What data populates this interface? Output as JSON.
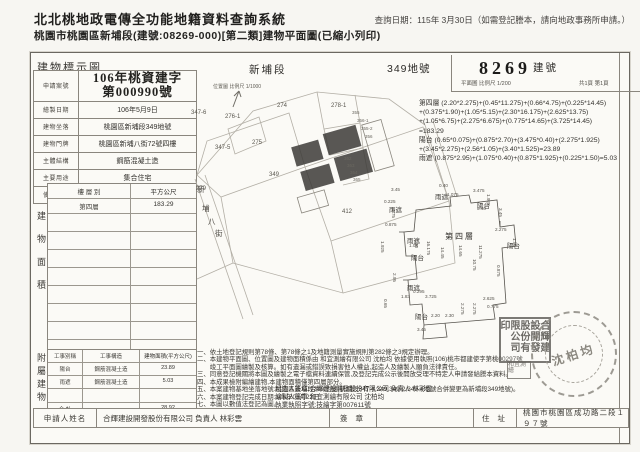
{
  "header": {
    "system_title": "北北桃地政電傳全功能地籍資料查詢系統",
    "query_date": "查詢日期：115年 3月30日（如需登記謄本，請向地政事務所申請。）",
    "doc_title": "桃園市桃園區新埔段(建號:08269-000)[第二類]建物平面圖(已縮小列印)"
  },
  "doc": {
    "diagram_label": "建物標示圖",
    "section_name": "新埔段",
    "lot_label": "349地號",
    "building_no": "8269",
    "building_label": "建號",
    "scale_plan": "平面圖 比例尺 1/200",
    "page_info": "共1頁 第1頁",
    "info_rows": [
      {
        "label": "申請案號",
        "value1": "106年桃資建字",
        "value2": "第000990號"
      },
      {
        "label": "繪製日期",
        "value": "106年5月9日"
      },
      {
        "label": "建物坐落",
        "value": "桃園區新埔段349地號"
      },
      {
        "label": "建物門牌",
        "value": "桃園區新埔八街72號四樓"
      },
      {
        "label": "主體結構",
        "value": "鋼筋混凝土造"
      },
      {
        "label": "主要用途",
        "value": "集合住宅"
      },
      {
        "label": "使用執照",
        "value": "(106)桃市都建使字第00297號"
      }
    ],
    "floor_section_label": "建物面積",
    "floor_table": {
      "col1": "樓 層 別",
      "col2": "平方公尺",
      "row_floor": "第四層",
      "row_area": "183.29",
      "total_label": "合  計",
      "total": "183.29"
    },
    "attached_section_label": "附屬建物",
    "attached_table": {
      "col1": "工事別稱",
      "col2": "工事構造",
      "col3": "建物面積(平方公尺)",
      "rows": [
        {
          "kind": "陽台",
          "structure": "鋼筋混凝土造",
          "area": "23.89"
        },
        {
          "kind": "雨遮",
          "structure": "鋼筋混凝土造",
          "area": "5.03"
        }
      ],
      "total_label": "合  計",
      "total": "28.92"
    },
    "calc_lines": [
      "第四層 (2.20*2.275)+(0.45*11.275)+(0.66*4.75)+(0.225*14.45)",
      "          +(0.375*1.90)+(1.05*5.15)+(2.30*16.175)+(2.625*13.75)",
      "          +(1.05*6.75)+(2.275*6.675)+(0.775*14.65)+(3.725*14.45)",
      "          =183.29",
      "陽台 (0.65*0.075)+(0.875*2.70)+(3.475*0.40)+(2.275*1.925)",
      "          +(3.45*2.275)+(2.56*1.05)+(3.40*1.525)=23.89",
      "雨遮 (0.875*2.95)+(1.075*0.40)+(0.875*1.925)+(0.225*1.50)=5.03"
    ],
    "notes_lines": [
      "一、依土地登記規則第78條、第78條之1及地籍測量實施規則第282條之3規定辦理。",
      "二、本建物平面圖、位置圖及建物面積係由 和宜測繪有限公司 沈柏均 依據使用執照(106)桃市都建使字第桃00297號",
      "　　竣工平面圖繪製及核算。如有遺漏或錯誤致損害他人權益,起造人及繪製人願負法律責任。",
      "三、同意登記機關將本圖及繪製之電子檔資料連續保管,及登記完成公示後開放受理不特定人申請發給謄本資料。",
      "四、本成果檢附編繪建物,本建物面積僅第四層部分。",
      "五、本案建物基地坐落地號:桃園區新埔段349地號(新埔段347-4,349,349-2,349-4地號合併變更為新埔段349地號)。",
      "六、本案建物登記完成日期:106年03月22日",
      "七、本圖以數值法登記為圖。"
    ],
    "sign_lines": [
      "起造人簽章:合輝建設開發股份有限公司 負責人 林彩雲",
      "繪製人簽章:和宜測繪有限公司 沈柏均",
      "執業執照字號:技繪字第007611號"
    ],
    "applicant": {
      "label": "申請人姓名",
      "name": "合輝建設開發股份有限公司 負責人 林彩雲",
      "sign_label": "簽 章",
      "addr_label": "住 址",
      "address": "桃園市桃園區成功路二段１９７號"
    },
    "location_map": {
      "caption": "位置圖 比例尺 1/1000",
      "labels": [
        {
          "t": "347-6",
          "x": 0,
          "y": 27
        },
        {
          "t": "276-1",
          "x": 34,
          "y": 31
        },
        {
          "t": "274",
          "x": 86,
          "y": 20
        },
        {
          "t": "278-1",
          "x": 140,
          "y": 20
        },
        {
          "t": "355",
          "x": 161,
          "y": 27,
          "c": "tiny"
        },
        {
          "t": "356-1",
          "x": 166,
          "y": 35,
          "c": "tiny"
        },
        {
          "t": "355-2",
          "x": 170,
          "y": 43,
          "c": "tiny"
        },
        {
          "t": "356",
          "x": 174,
          "y": 51,
          "c": "tiny"
        },
        {
          "t": "347-5",
          "x": 24,
          "y": 62
        },
        {
          "t": "275",
          "x": 61,
          "y": 57
        },
        {
          "t": "279",
          "x": 5,
          "y": 103
        },
        {
          "t": "349",
          "x": 78,
          "y": 89
        },
        {
          "t": "362",
          "x": 153,
          "y": 73,
          "c": "tiny"
        },
        {
          "t": "363",
          "x": 156,
          "y": 80,
          "c": "tiny"
        },
        {
          "t": "364",
          "x": 159,
          "y": 87,
          "c": "tiny"
        },
        {
          "t": "365",
          "x": 162,
          "y": 94,
          "c": "tiny"
        },
        {
          "t": "412",
          "x": 151,
          "y": 126
        },
        {
          "t": "新",
          "x": 6,
          "y": 101,
          "c": "street"
        },
        {
          "t": "埔",
          "x": 11,
          "y": 120,
          "c": "street"
        },
        {
          "t": "八",
          "x": 17,
          "y": 133,
          "c": "street"
        },
        {
          "t": "街",
          "x": 24,
          "y": 145,
          "c": "street"
        }
      ]
    },
    "floor_plan": {
      "labels": [
        {
          "t": "雨遮",
          "x": 52,
          "y": 8
        },
        {
          "t": "陽台",
          "x": 94,
          "y": 17
        },
        {
          "t": "雨遮",
          "x": 6,
          "y": 21
        },
        {
          "t": "雨遮",
          "x": 24,
          "y": 52
        },
        {
          "t": "陽台",
          "x": 28,
          "y": 69
        },
        {
          "t": "第四層",
          "x": 62,
          "y": 48,
          "c": "big"
        },
        {
          "t": "陽台",
          "x": 124,
          "y": 57
        },
        {
          "t": "雨遮",
          "x": 24,
          "y": 99
        },
        {
          "t": "陽台",
          "x": 32,
          "y": 128
        }
      ],
      "dims": [
        {
          "t": "3.45",
          "x": 8,
          "y": 4
        },
        {
          "t": "0.40",
          "x": 56,
          "y": 0
        },
        {
          "t": "1.075",
          "x": 64,
          "y": 9
        },
        {
          "t": "3.475",
          "x": 90,
          "y": 5
        },
        {
          "t": "1.925",
          "x": 108,
          "y": 11,
          "v": 1
        },
        {
          "t": "3.40",
          "x": 94,
          "y": 23
        },
        {
          "t": "3.45",
          "x": 120,
          "y": 25,
          "v": 1
        },
        {
          "t": "0.225",
          "x": 1,
          "y": 16
        },
        {
          "t": "4.75",
          "x": 13,
          "y": 26,
          "v": 1
        },
        {
          "t": "0.875",
          "x": 2,
          "y": 39
        },
        {
          "t": "1.05",
          "x": 26,
          "y": 60
        },
        {
          "t": "1.925",
          "x": 2,
          "y": 58,
          "v": 1
        },
        {
          "t": "2.30",
          "x": 36,
          "y": 56,
          "v": 1
        },
        {
          "t": "16.175",
          "x": 48,
          "y": 58,
          "v": 1
        },
        {
          "t": "14.45",
          "x": 62,
          "y": 64,
          "v": 1
        },
        {
          "t": "14.65",
          "x": 80,
          "y": 62,
          "v": 1
        },
        {
          "t": "11.275",
          "x": 100,
          "y": 62,
          "v": 1
        },
        {
          "t": "10.75",
          "x": 94,
          "y": 76,
          "v": 1
        },
        {
          "t": "2.275",
          "x": 112,
          "y": 44
        },
        {
          "t": "1.50",
          "x": 134,
          "y": 55,
          "v": 1
        },
        {
          "t": "0.875",
          "x": 118,
          "y": 82,
          "v": 1
        },
        {
          "t": "0.295",
          "x": 30,
          "y": 106
        },
        {
          "t": "1.83",
          "x": 18,
          "y": 111
        },
        {
          "t": "3.725",
          "x": 42,
          "y": 111
        },
        {
          "t": "0.65",
          "x": 5,
          "y": 116,
          "v": 1
        },
        {
          "t": "2.95",
          "x": 14,
          "y": 90,
          "v": 1
        },
        {
          "t": "2.275",
          "x": 82,
          "y": 120,
          "v": 1
        },
        {
          "t": "2.275",
          "x": 94,
          "y": 120,
          "v": 1
        },
        {
          "t": "2.625",
          "x": 100,
          "y": 113
        },
        {
          "t": "0.775",
          "x": 104,
          "y": 121
        },
        {
          "t": "2.20",
          "x": 48,
          "y": 130
        },
        {
          "t": "2.30",
          "x": 62,
          "y": 130
        },
        {
          "t": "3.45",
          "x": 34,
          "y": 144
        }
      ]
    },
    "stamps": {
      "company_seal": "合輝建設開發股份有限公司印",
      "secondary_seal": "和宜測繪",
      "surveyor_seal": "沈柏均"
    }
  }
}
